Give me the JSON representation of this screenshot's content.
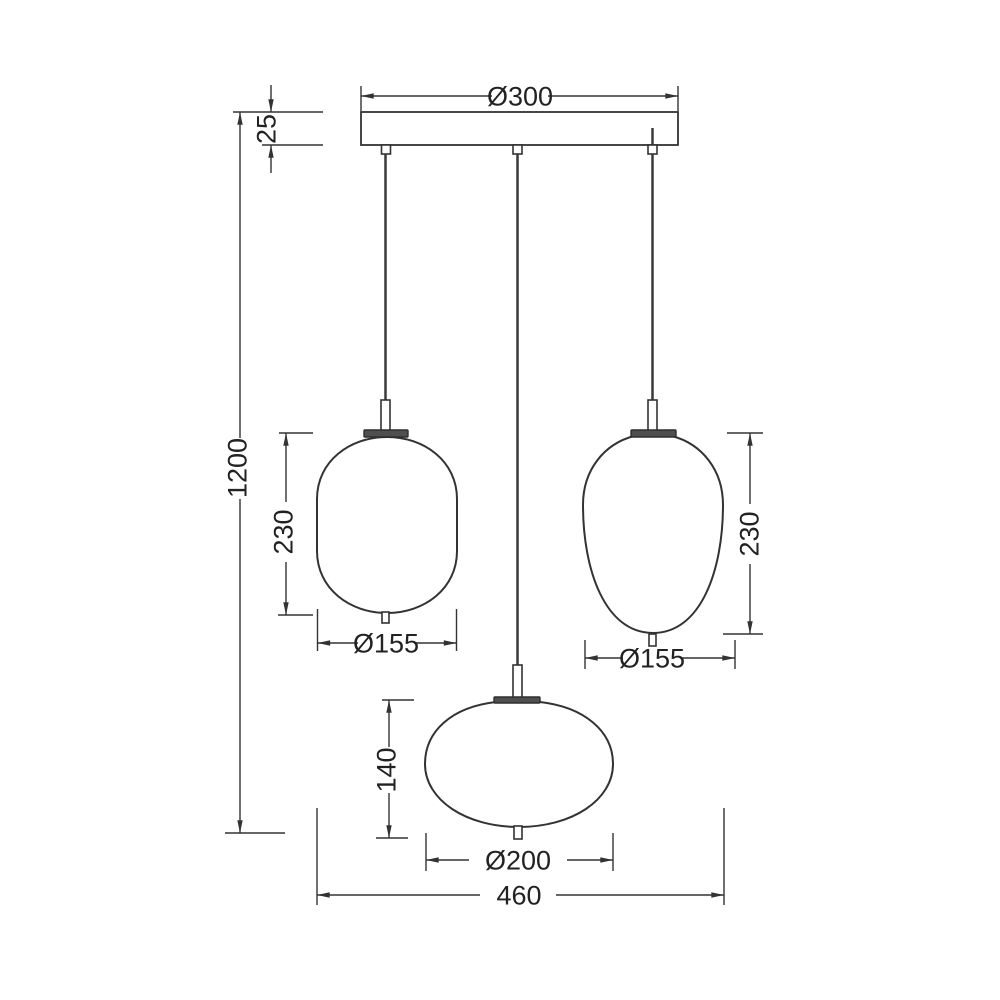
{
  "drawing": {
    "style": {
      "background": "#ffffff",
      "line_color": "#333333",
      "cap_fill": "#4f4f4f"
    },
    "dims": {
      "canopy_diameter": "Ø300",
      "canopy_height": "25",
      "overall_drop": "1200",
      "left_shade_height": "230",
      "left_shade_diameter": "Ø155",
      "right_shade_height": "230",
      "right_shade_diameter": "Ø155",
      "bottom_shade_height": "140",
      "bottom_shade_diameter": "Ø200",
      "overall_width": "460"
    }
  }
}
